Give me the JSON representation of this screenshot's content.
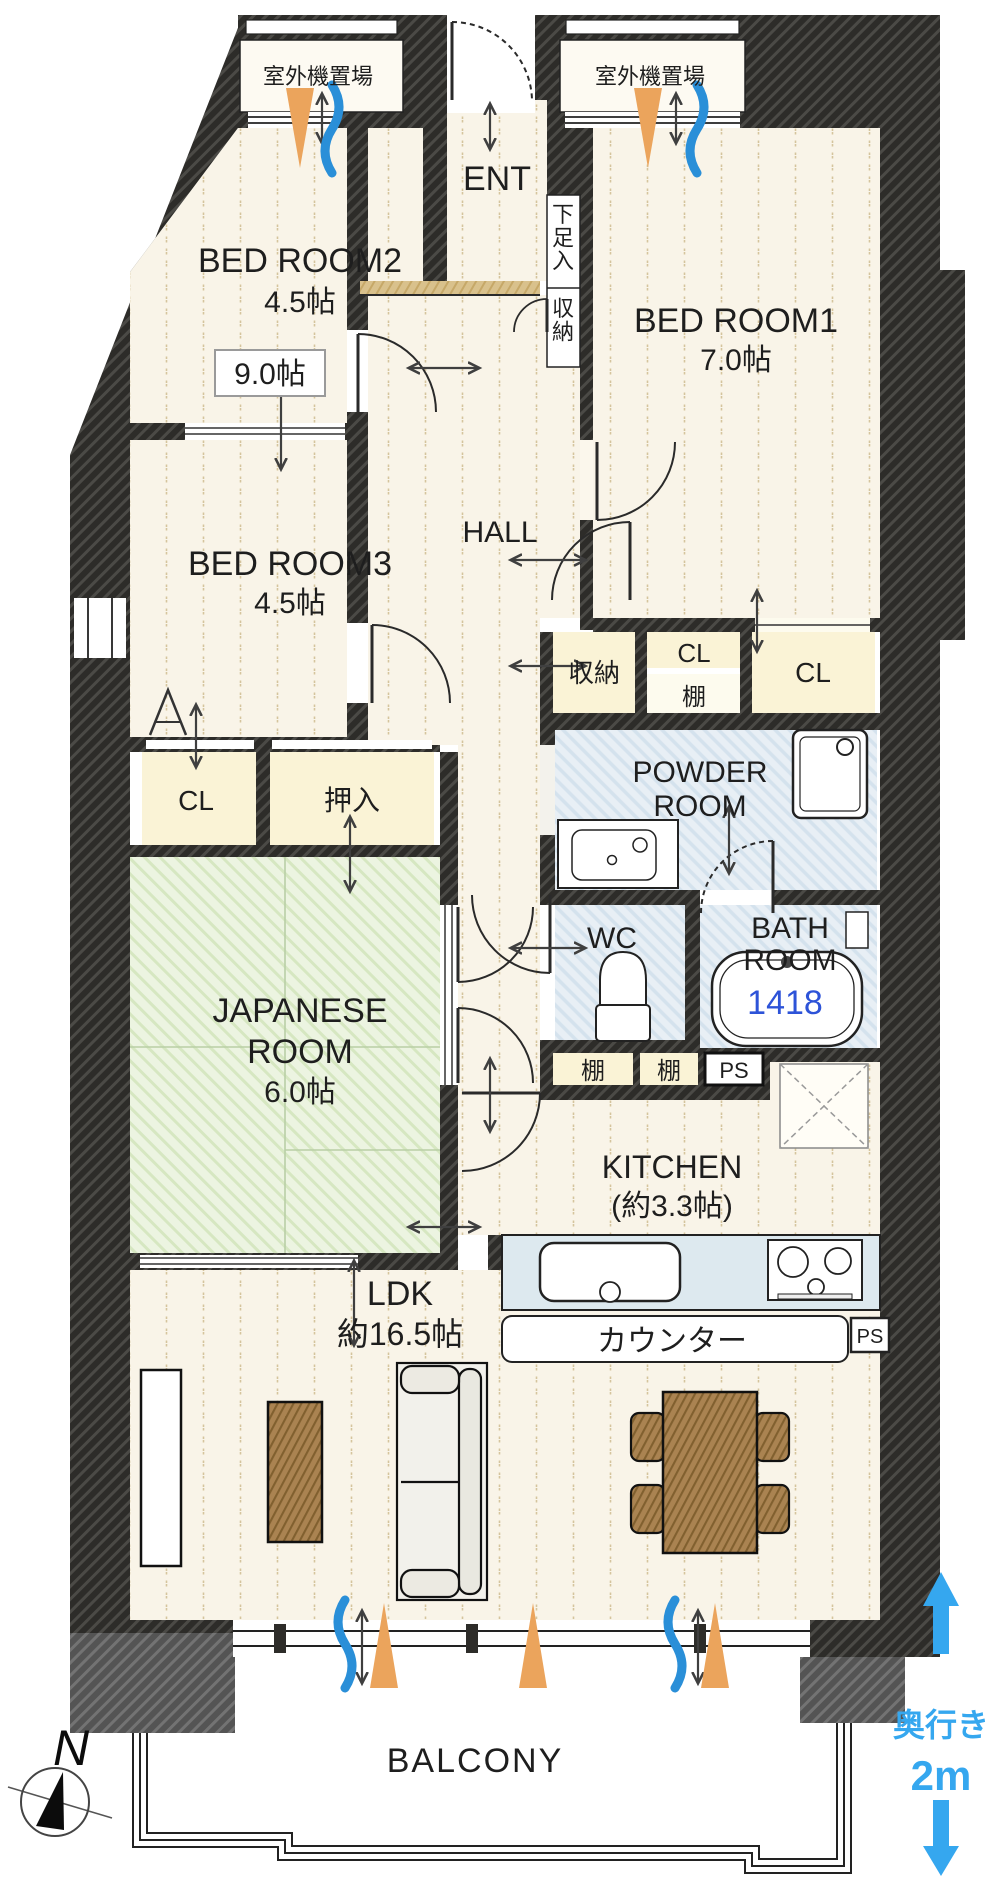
{
  "plan": {
    "outdoor_left": "室外機置場",
    "outdoor_right": "室外機置場",
    "ent": "ENT",
    "shoe_box": "下足入",
    "ent_storage": "収納",
    "bedroom2": {
      "name": "BED ROOM2",
      "size": "4.5帖"
    },
    "combined_size": "9.0帖",
    "bedroom1": {
      "name": "BED ROOM1",
      "size": "7.0帖"
    },
    "bedroom3": {
      "name": "BED ROOM3",
      "size": "4.5帖"
    },
    "hall": "HALL",
    "hall_storage": "収納",
    "cl_hall": "CL",
    "shelf_hall": "棚",
    "cl_bedroom1": "CL",
    "powder": {
      "line1": "POWDER",
      "line2": "ROOM"
    },
    "cl_bedroom3": "CL",
    "oshiire": "押入",
    "bath": {
      "line1": "BATH",
      "line2": "ROOM",
      "tub_size": "1418"
    },
    "wc": "WC",
    "shelf1": "棚",
    "shelf2": "棚",
    "ps1": "PS",
    "japanese": {
      "line1": "JAPANESE",
      "line2": "ROOM",
      "size": "6.0帖"
    },
    "kitchen": {
      "name": "KITCHEN",
      "size": "(約3.3帖)"
    },
    "counter": "カウンター",
    "ps2": "PS",
    "ldk": {
      "name": "LDK",
      "size": "約16.5帖"
    },
    "balcony": "BALCONY",
    "compass": "N",
    "depth": {
      "label": "奥行き",
      "value": "2m"
    },
    "colors": {
      "accent_blue": "#35a7ef",
      "tub_blue": "#2d53d8",
      "sun_orange": "#eba45c",
      "wind_blue": "#2a8fd8"
    }
  }
}
